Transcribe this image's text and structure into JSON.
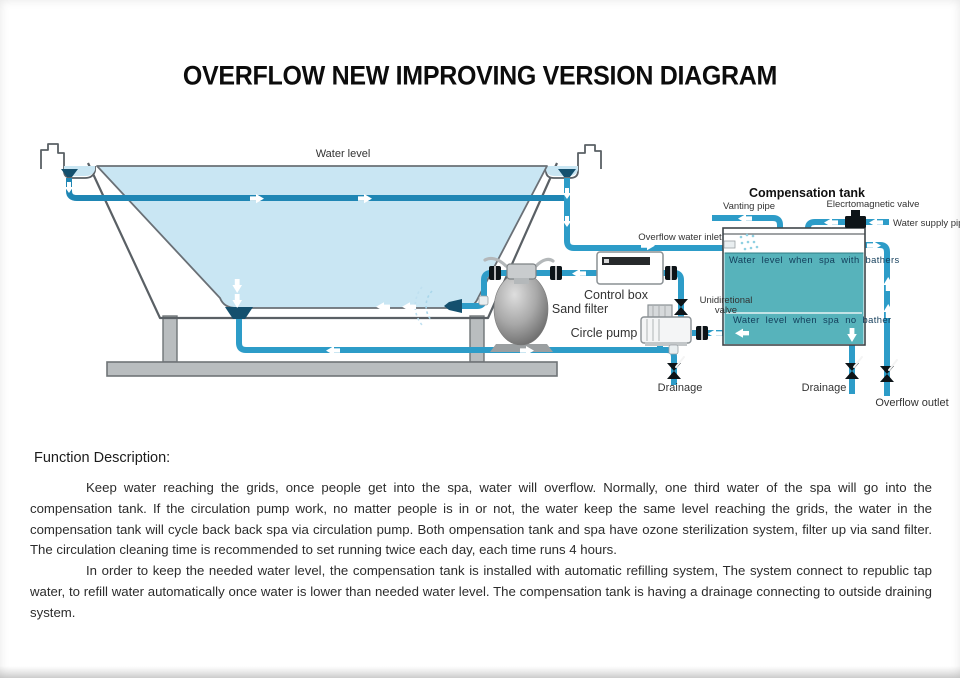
{
  "page": {
    "title": "OVERFLOW NEW IMPROVING VERSION DIAGRAM"
  },
  "diagram": {
    "labels": {
      "water_level": "Water level",
      "compensation_tank": "Compensation tank",
      "vanting_pipe": "Vanting pipe",
      "electromagnetic_valve": "Elecrtomagnetic  valve",
      "water_supply_pipe": "Water supply pipe",
      "overflow_water_inlet": "Overflow water inlet",
      "control_box": "Control box",
      "sand_filter": "Sand  filter",
      "unidirectional_valve_line1": "Unidiretional",
      "unidirectional_valve_line2": "valve",
      "circle_pump": "Circle pump",
      "water_level_with_bathers": "Water level when spa with bathers",
      "water_level_no_bather": "Water level when spa no bather",
      "drainage_left": "Drainage",
      "drainage_right": "Drainage",
      "overflow_outlet": "Overflow outlet"
    },
    "colors": {
      "pipe_blue": "#2d9cc8",
      "pipe_dark_blue": "#14506e",
      "spa_water": "#c9e6f3",
      "tank_water": "#57b3bb",
      "structure_gray": "#b9bdbf",
      "valve_black": "#0d1418"
    }
  },
  "description": {
    "heading": "Function Description:",
    "paragraphs": [
      "Keep water reaching the grids, once people get into the spa, water will overflow. Normally, one third water of the spa will go into the compensation tank. If the circulation pump work, no matter people is in or not, the water keep the same level reaching the grids, the water in the compensation tank will cycle back back spa via circulation pump. Both ompensation tank and spa have ozone sterilization system, filter up via sand filter. The circulation cleaning time is recommended to set running twice each day, each time runs 4 hours.",
      "In order to keep the needed water level, the compensation tank is installed with automatic refilling system, The system connect to republic tap water, to refill water automatically once water is lower than needed water level. The compensation tank is having a drainage connecting to outside draining system."
    ]
  }
}
